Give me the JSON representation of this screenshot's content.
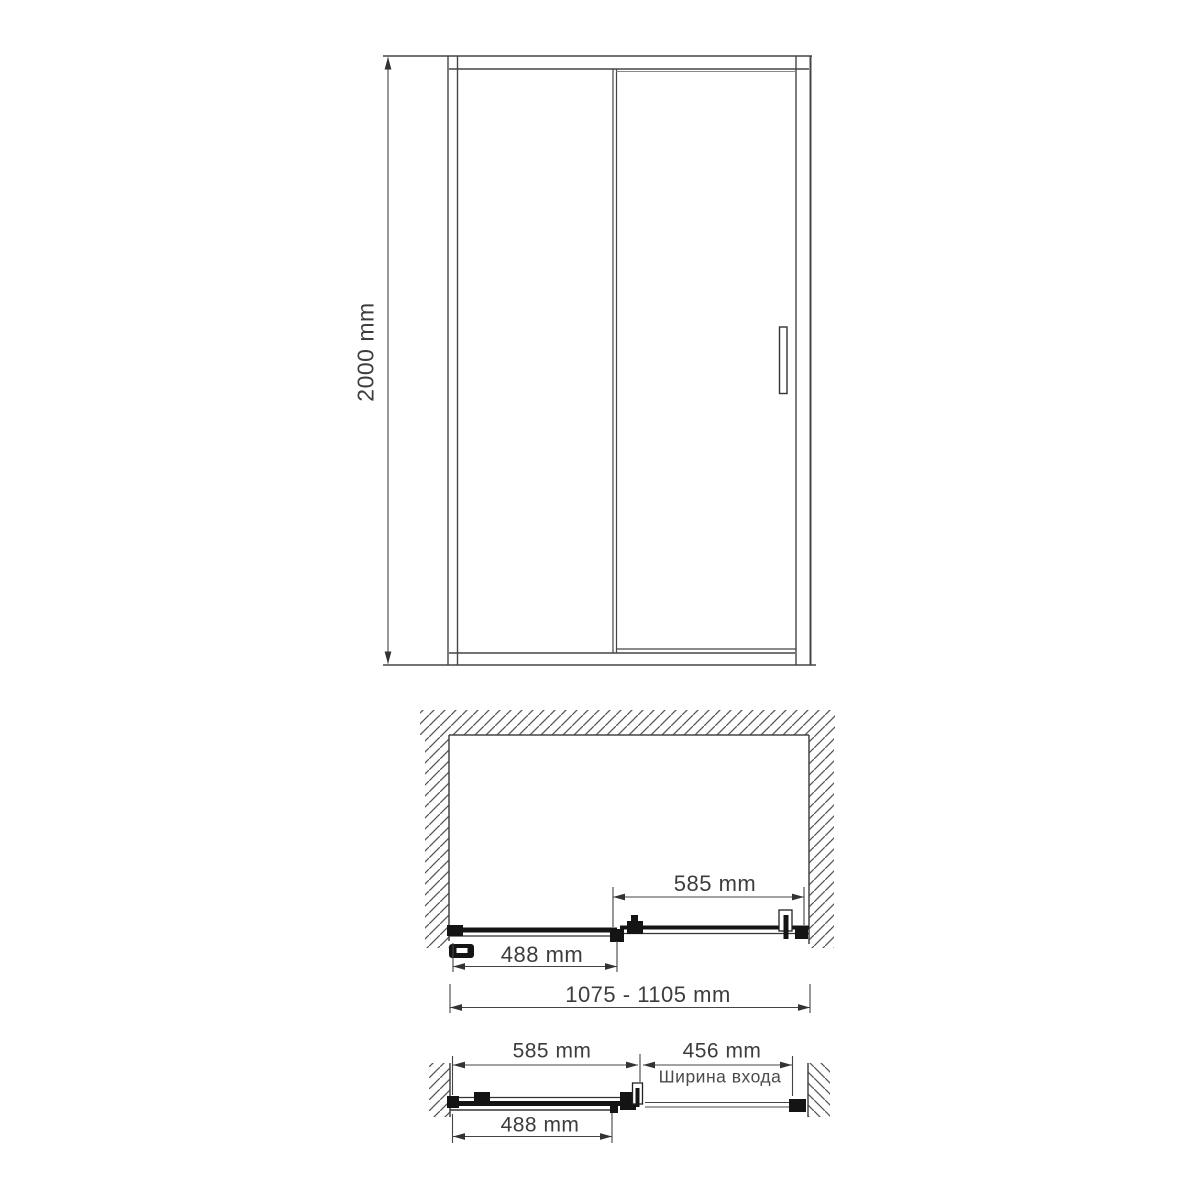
{
  "drawing": {
    "background": "#ffffff",
    "line_color": "#454545",
    "panel_color": "#141414",
    "text_color": "#3d3d3d",
    "front_view": {
      "height_dim": "2000 mm"
    },
    "plan_view_closed": {
      "sliding_panel_dim": "585 mm",
      "fixed_panel_dim": "488 mm",
      "overall_width_dim": "1075 - 1105 mm"
    },
    "plan_view_open": {
      "sliding_panel_dim": "585 mm",
      "entry_width_dim": "456 mm",
      "entry_width_caption": "Ширина входа",
      "fixed_panel_dim": "488 mm"
    }
  }
}
